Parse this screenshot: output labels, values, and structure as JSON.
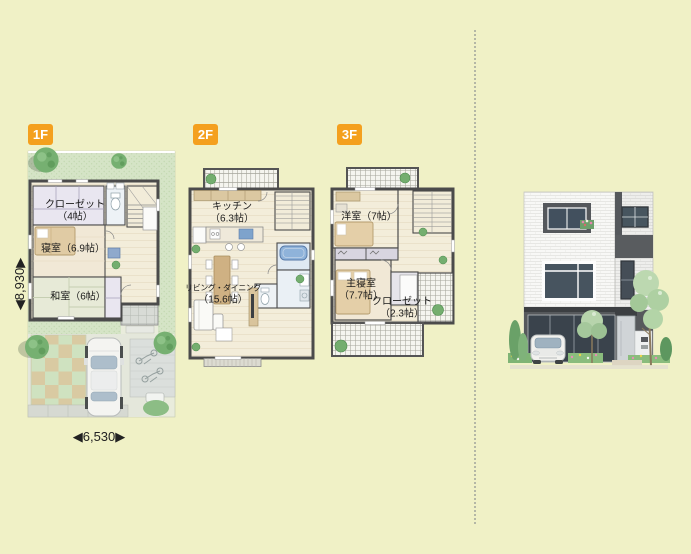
{
  "page": {
    "background": "#f0f1c6"
  },
  "floor_plans": [
    {
      "badge": "1F",
      "rooms": {
        "closet": {
          "line1": "クローゼット",
          "line2": "（4帖）"
        },
        "bedroom": {
          "line1": "寝室（6.9帖）"
        },
        "japanese_room": {
          "line1": "和室（6帖）"
        }
      },
      "dimensions": {
        "width": "◀6,530▶",
        "depth": "◀8,930▶"
      }
    },
    {
      "badge": "2F",
      "rooms": {
        "kitchen": {
          "line1": "キッチン",
          "line2": "（6.3帖）"
        },
        "living_dining": {
          "line1": "リビング・ダイニング",
          "line2": "（15.6帖）"
        }
      }
    },
    {
      "badge": "3F",
      "rooms": {
        "western_room": {
          "line1": "洋室（7帖）"
        },
        "master_bedroom": {
          "line1": "主寝室",
          "line2": "（7.7帖）"
        },
        "closet": {
          "line1": "クローゼット",
          "line2": "（2.3帖）"
        }
      }
    }
  ],
  "colors": {
    "badge": "#f4a01e",
    "wall": "#4b4b4b",
    "floor": "#f3edda",
    "tatami": "#e7ead7",
    "lawn": "#d5e4c6",
    "bath": "#8fb3da",
    "background": "#f0f1c6"
  },
  "exterior": {
    "type": "three-story-house-front-illustration",
    "features": [
      "white-brick-facade",
      "dark-accent-panels",
      "car",
      "trees",
      "flower-beds",
      "entrance-door"
    ]
  }
}
